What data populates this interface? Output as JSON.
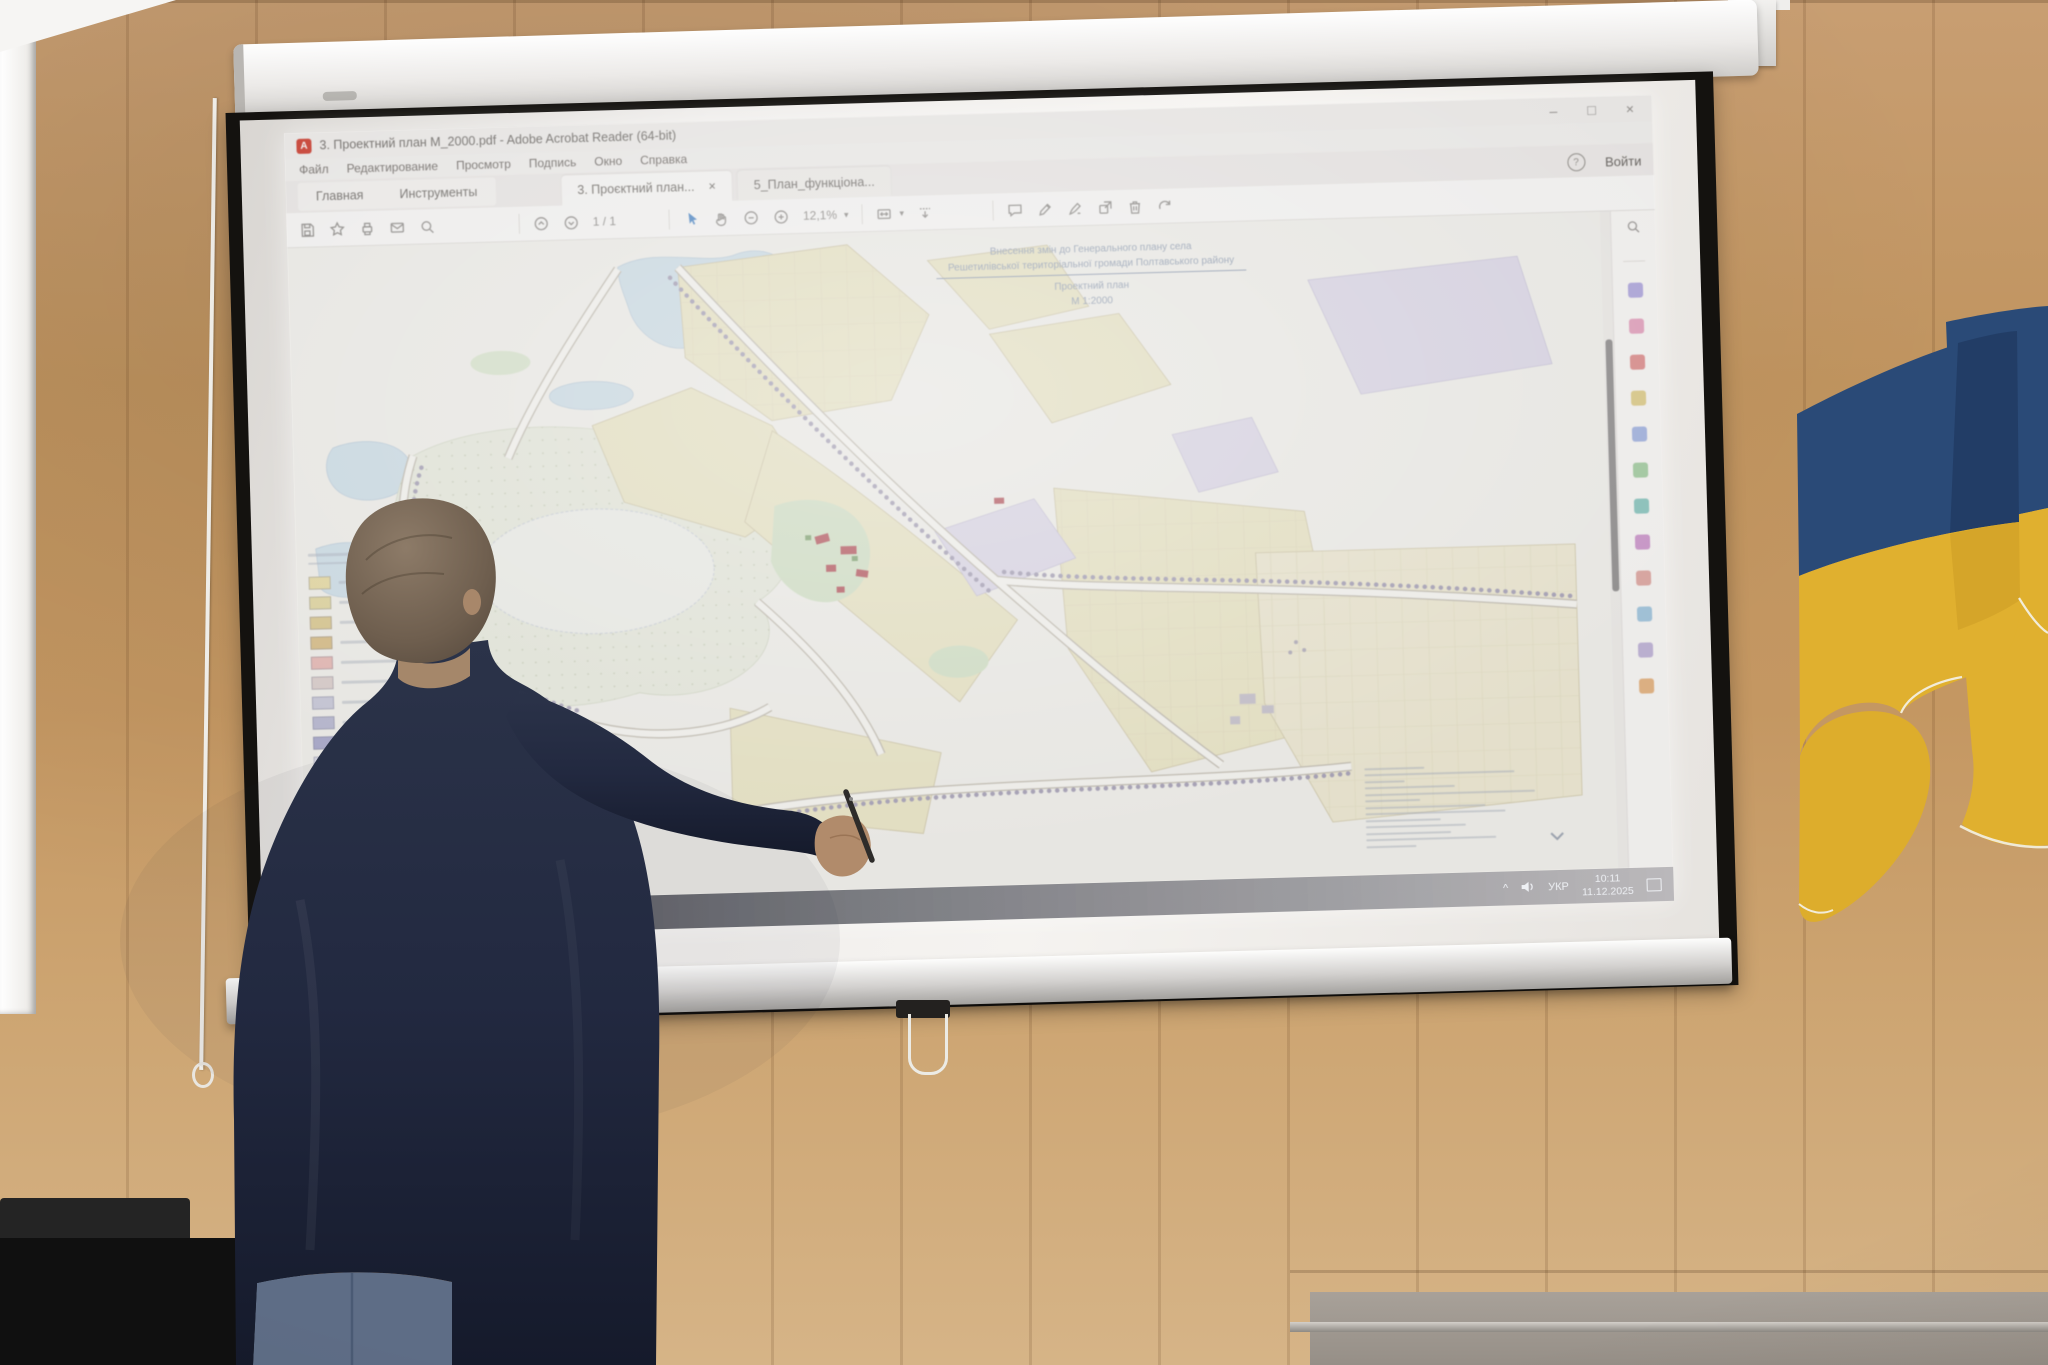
{
  "acrobat": {
    "window_title": "3. Проектний план М_2000.pdf - Adobe Acrobat Reader (64-bit)",
    "menu": [
      "Файл",
      "Редактирование",
      "Просмотр",
      "Подпись",
      "Окно",
      "Справка"
    ],
    "nav_tabs": [
      {
        "label": "Главная"
      },
      {
        "label": "Инструменты"
      }
    ],
    "doc_tabs": [
      {
        "label": "3. Проєктний план..."
      },
      {
        "label": "5_План_функціона..."
      }
    ],
    "sign_in_label": "Войти",
    "page_indicator": "1 / 1",
    "zoom_level": "12,1%",
    "pdf_logo_letter": "A",
    "toolbar_icons": [
      "save",
      "star",
      "print",
      "email",
      "search",
      "page-up",
      "page-down",
      "select",
      "hand",
      "zoom-out",
      "zoom-in",
      "fit-width",
      "page-display",
      "download",
      "comment",
      "highlight",
      "sign",
      "share",
      "delete",
      "refresh"
    ],
    "tool_rail_colors": [
      "#9b90d8",
      "#e08bb0",
      "#d87070",
      "#d8c06a",
      "#8ba0dc",
      "#8cc08a",
      "#6ab8b0",
      "#c07ac0",
      "#d8908a",
      "#88b8d8",
      "#b0a0d0",
      "#e0a060"
    ]
  },
  "document_page": {
    "stamp": {
      "line1": "Внесення змін до Генерального плану села",
      "line2": "Решетилівської територіальної громади Полтавського району",
      "line3": "Проектний план",
      "line4": "М 1:2000"
    },
    "legend_colors": [
      "#e8dca2",
      "#e2d79e",
      "#dcc98e",
      "#d9be85",
      "#e8b9b4",
      "#dccfcc",
      "#c9c9da",
      "#b9b9d2",
      "#a9a9cc",
      "#d9d9e6",
      "#cfe3cf",
      "#b9d8b9",
      "#a5cfc2",
      "#96c8b8",
      "#cfe0ea"
    ],
    "palette": {
      "zone_yellow": "#ece7c6",
      "water": "#cfe0ea",
      "meadow": "#e9ecdf",
      "zone_lavender": "#ded9ea",
      "greenery": "#d5e4c8",
      "building_red": "#b5525a",
      "tree_line": "#a8a2b8"
    }
  },
  "taskbar": {
    "language": "УКР",
    "time": "10:11",
    "date": "11.12.2025"
  },
  "scene": {
    "flag_blue": "#2a4a77",
    "flag_yellow": "#e0b02f",
    "wall_wood": "#c49a6d"
  },
  "icons": {
    "minimize": "–",
    "maximize": "□",
    "close": "×",
    "question": "?",
    "caret_down": "▾",
    "chevron_up": "^"
  }
}
